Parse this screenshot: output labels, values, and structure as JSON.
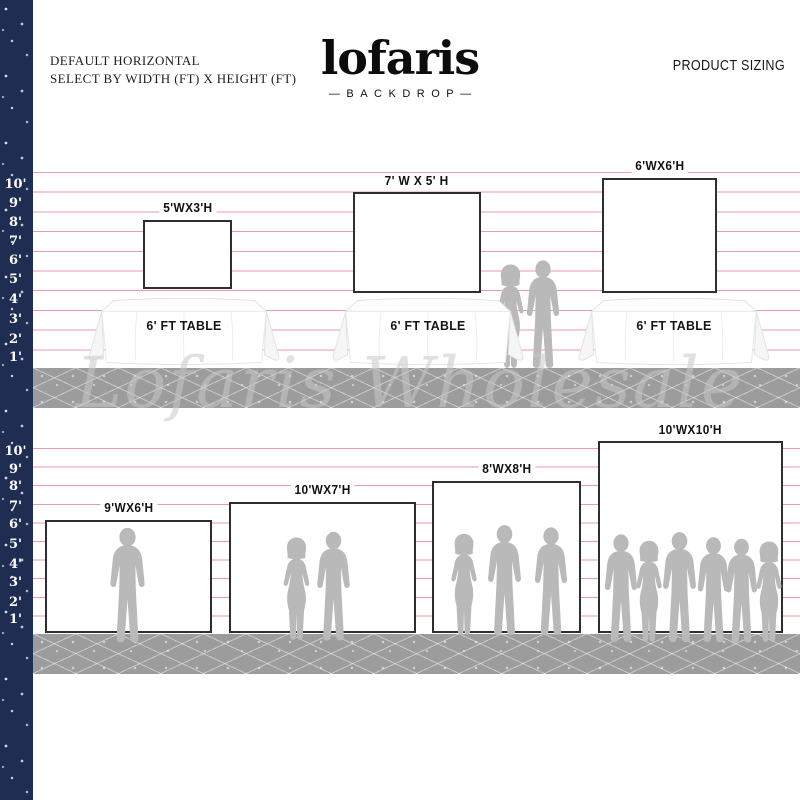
{
  "header": {
    "line1": "DEFAULT HORIZONTAL",
    "line2": "SELECT BY WIDTH (FT) X HEIGHT (FT)",
    "logo": "lofaris",
    "logo_sub": "—BACKDROP—",
    "right_title": "PRODUCT SIZING"
  },
  "watermark": "Lofaris Wholesale",
  "ruler": {
    "feet": [
      "10'",
      "9'",
      "8'",
      "7'",
      "6'",
      "5'",
      "4'",
      "3'",
      "2'",
      "1'"
    ]
  },
  "top_row": {
    "backdrops": [
      {
        "label": "5'WX3'H",
        "width_ft": 5,
        "height_ft": 3
      },
      {
        "label": "7' W X 5' H",
        "width_ft": 7,
        "height_ft": 5
      },
      {
        "label": "6'WX6'H",
        "width_ft": 6,
        "height_ft": 6
      }
    ],
    "table_label": "6' FT TABLE",
    "tables_count": 3,
    "people_count": 2
  },
  "bottom_row": {
    "backdrops": [
      {
        "label": "9'WX6'H",
        "width_ft": 9,
        "height_ft": 6,
        "people": 1
      },
      {
        "label": "10'WX7'H",
        "width_ft": 10,
        "height_ft": 7,
        "people": 2
      },
      {
        "label": "8'WX8'H",
        "width_ft": 8,
        "height_ft": 8,
        "people": 3
      },
      {
        "label": "10'WX10'H",
        "width_ft": 10,
        "height_ft": 10,
        "people": 6
      }
    ]
  },
  "colors": {
    "navy_strip": "#1f2d52",
    "guide_line_pink": "#eb9aa5",
    "floor_gray": "#9c9c9c",
    "silhouette_gray": "#b9b9b9",
    "backdrop_border": "#2e2e2e"
  }
}
